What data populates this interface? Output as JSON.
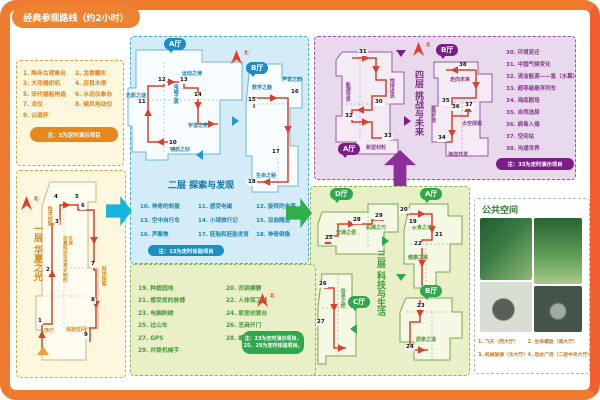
{
  "frame": {
    "title": "经典参观路线（约2小时）"
  },
  "north": "北",
  "halls": {
    "a": "A厅",
    "b": "B厅",
    "c": "C厅",
    "d": "D厅"
  },
  "floor1": {
    "title": "一层 华夏之光",
    "items": [
      "1. 陶寺古观象台",
      "2. 龙骨翻车",
      "3. 大花楼织机",
      "4. 应县木塔",
      "5. 宋代福船构造",
      "6. 水运仪象台",
      "7. 浑仪",
      "8. 候风地动仪",
      "9. 公道杯"
    ],
    "note": "注：3为定时演示项目",
    "stops": [
      "1",
      "2",
      "3",
      "4",
      "5",
      "6",
      "7",
      "8",
      "9"
    ],
    "labels": {
      "xuting": "序厅",
      "jishu": "技术创新",
      "jiaoliu": "华夏科技与世界文明的交流",
      "kexue": "科学探索",
      "tiyan": "体验空间"
    }
  },
  "floor2": {
    "title": "二层 探索与发现",
    "items": [
      "10. 神奇的斜屋",
      "11. 感受电磁",
      "12. 旋转的金蛋",
      "13. 空中自行车",
      "14. 小球旅行记",
      "15. 双曲隧道",
      "16. 声聚焦",
      "17. 胚胎和胚胎发育",
      "18. 神奇倒像"
    ],
    "note": "注：13为定时体验项目",
    "stops": [
      "10",
      "11",
      "12",
      "13",
      "14",
      "15",
      "16",
      "17",
      "18"
    ],
    "areas": {
      "yundong": "运动之律",
      "guangying": "光影之谜",
      "dianci": "电磁之奥",
      "yuzhou": "宇宙之奇",
      "wuzhi": "物质之妙",
      "shuxue": "数学之魅",
      "shengyin": "声音之韵",
      "shengming": "生命之秘"
    }
  },
  "floor3": {
    "title": "三层 科技与生活",
    "items": [
      "19. 种植园地",
      "20. 农耕撷要",
      "21. 感受您的脉搏",
      "22. 人体保卫战",
      "23. 电脑刺绣",
      "24. 家居创意台",
      "25. 过山车",
      "26. 芝麻开门",
      "27. GPS",
      "28. 螺旋推进器",
      "29. 并联机械手"
    ],
    "note1": "注：23为定时演示项目，",
    "note2": "25、29为定时体验项目。",
    "stops": [
      "19",
      "20",
      "21",
      "22",
      "23",
      "24",
      "25",
      "26",
      "27",
      "28",
      "29"
    ],
    "areas": {
      "jiaotong": "交通之便",
      "jixie": "机械之巧",
      "yishi": "衣食之本",
      "jiankang": "健康之路",
      "jujia": "居家之道",
      "xinxi": "信息之桥"
    }
  },
  "floor4": {
    "title": "四层 挑战与未来",
    "items": [
      "30. 环境变迁",
      "31. 中国气候变化",
      "32. 清洁能源——氢（水幕）",
      "33. 超导磁悬浮列车",
      "34. 海底剧场",
      "35. 自然选择",
      "36. 病毒入侵",
      "37. 空间站",
      "38. 沟通世界"
    ],
    "note": "注：33为定时演示项目",
    "stops": [
      "30",
      "31",
      "32",
      "33",
      "34",
      "35",
      "36",
      "37",
      "38"
    ],
    "areas": {
      "nengyuan": "能源世界",
      "diqiu": "地球述说",
      "xinxing": "新型材料",
      "zouxiang": "走向未来",
      "jiyin": "基因生命",
      "taikong": "太空探索",
      "haiyang": "海洋开发"
    }
  },
  "public_space": {
    "title": "公共空间",
    "captions": [
      "1. 飞天（西大厅）",
      "2. 生命螺旋（南大厅）",
      "3. 机械旋律（东大厅）",
      "4. 恐龙广场（二层中央大厅）"
    ]
  },
  "colors": {
    "orange": "#ee7b2f",
    "blue": "#1b8ec2",
    "green": "#2fa84c",
    "purple": "#7b1f86",
    "route_red": "#d8402a"
  }
}
